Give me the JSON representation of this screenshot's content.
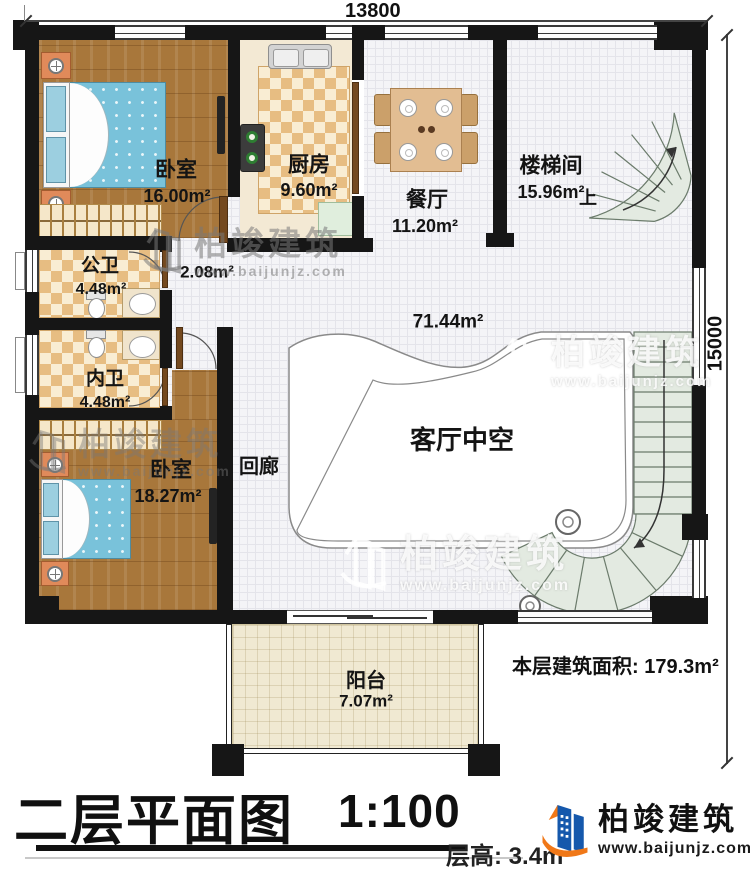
{
  "dimensions": {
    "top": "13800",
    "right": "15000"
  },
  "rooms": {
    "bedroom1": {
      "name": "卧室",
      "area": "16.00m²"
    },
    "kitchen": {
      "name": "厨房",
      "area": "9.60m²"
    },
    "dining": {
      "name": "餐厅",
      "area": "11.20m²"
    },
    "stairwell": {
      "name": "楼梯间",
      "area": "15.96m²",
      "up_label": "上"
    },
    "hall": {
      "area": "2.08m²"
    },
    "public_bath": {
      "name": "公卫",
      "area": "4.48m²"
    },
    "private_bath": {
      "name": "内卫",
      "area": "4.48m²"
    },
    "bedroom2": {
      "name": "卧室",
      "area": "18.27m²"
    },
    "corridor": {
      "name": "回廊"
    },
    "void": {
      "name": "客厅中空",
      "area": "71.44m²"
    },
    "balcony": {
      "name": "阳台",
      "area": "7.07m²"
    }
  },
  "footer": {
    "title": "二层平面图",
    "scale": "1:100",
    "floor_height_label": "层高:",
    "floor_height_value": "3.4m",
    "floor_area_label": "本层建筑面积:",
    "floor_area_value": "179.3m²"
  },
  "branding": {
    "logo_name": "柏竣建筑",
    "logo_url": "www.baijunjz.com",
    "watermark_name": "柏竣建筑",
    "watermark_url": "www.baijunjz.com",
    "logo_blue": "#1558ac",
    "logo_orange": "#f07818"
  }
}
